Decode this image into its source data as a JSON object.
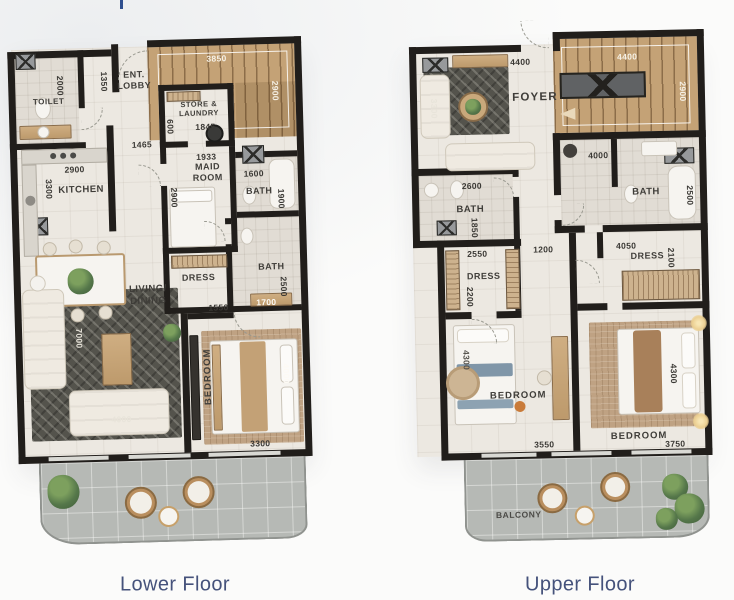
{
  "page": {
    "lower_title": "Lower Floor",
    "upper_title": "Upper Floor",
    "title_color": "#45527b",
    "wall_color": "#211e1b",
    "stair_wood_color": "#c4a276",
    "balcony_color": "#b6b9b5",
    "cropped_title_fragment_color": "#2f4f8f"
  },
  "lower": {
    "rooms": {
      "toilet": "TOILET",
      "ent_lobby": "ENT. LOBBY",
      "store_laundry": "STORE & LAUNDRY",
      "kitchen": "KITCHEN",
      "maid_room": "MAID ROOM",
      "bath_mid": "BATH",
      "bath_lower": "BATH",
      "dress": "DRESS",
      "living_dining": "LIVING/ DINING",
      "bedroom": "BEDROOM"
    },
    "dims": {
      "toilet_d": "2000",
      "lobby_d": "1350",
      "stairs_w": "3850",
      "stairs_d": "2900",
      "store_d": "600",
      "store_w": "1845",
      "hall_w": "1465",
      "kitchen_w": "2900",
      "kitchen_d": "3300",
      "maid_w": "1933",
      "maid_d": "2900",
      "bath_mid_w": "1600",
      "bath_mid_d": "1900",
      "passage_w": "1550",
      "bath_lower_d": "2500",
      "bath_lower_w": "1700",
      "living_d": "7000",
      "living_w": "4000",
      "bedroom_d": "4000",
      "bedroom_w": "3300"
    }
  },
  "upper": {
    "rooms": {
      "foyer": "FOYER",
      "bath_left": "BATH",
      "bath_right": "BATH",
      "dress_left": "DRESS",
      "dress_right": "DRESS",
      "bedroom_left": "BEDROOM",
      "bedroom_right": "BEDROOM",
      "balcony": "BALCONY"
    },
    "dims": {
      "foyer_w": "4400",
      "stairs_w": "4400",
      "stairs_d": "2900",
      "seating_d": "3300",
      "bath_left_w": "2600",
      "bath_left_d": "1850",
      "bath_right_w": "4000",
      "bath_right_d": "2500",
      "dress_left_top_w": "2550",
      "hall_w": "1200",
      "dress_right_w": "4050",
      "dress_right_d": "2100",
      "dress_left_d": "2200",
      "bedroom_left_d": "4300",
      "bedroom_left_w": "3550",
      "bedroom_right_d": "4300",
      "bedroom_right_w": "3750"
    }
  }
}
